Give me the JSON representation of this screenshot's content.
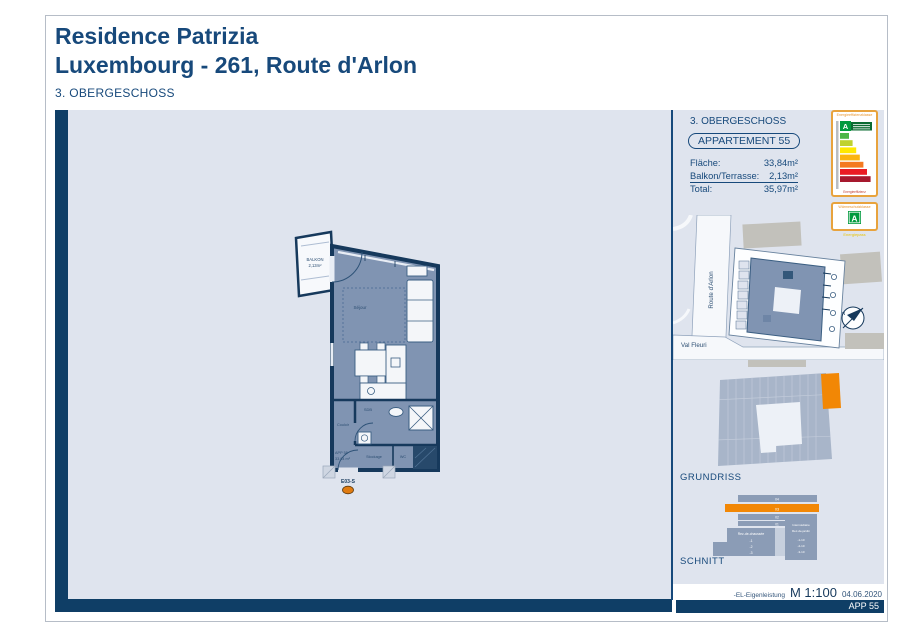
{
  "colors": {
    "navy_text": "#17497B",
    "frame_navy": "#0F3E66",
    "content_lavender": "#DFE4EE",
    "plan_floor": "#8094B2",
    "highlight_orange": "#F28705",
    "map_building_gray": "#C2C1BB",
    "energy_border_orange": "#E8A33D",
    "energy_class_green": "#009A3D",
    "energy_scale_colors": [
      "#4CB648",
      "#BFD22E",
      "#FFE800",
      "#FBB40F",
      "#F47A20",
      "#EA1C24",
      "#A6192E"
    ]
  },
  "header": {
    "title_line1": "Residence Patrizia",
    "title_line2": "Luxembourg - 261, Route d'Arlon",
    "subtitle": "3. OBERGESCHOSS"
  },
  "floorplan": {
    "balkon_line1": "BALKON",
    "balkon_line2": "2,13m²",
    "room_sejour": "Séjour",
    "room_sdb": "SDB",
    "room_couloir": "Couloir",
    "room_stockage": "Stockage",
    "room_wc": "WC",
    "apt_label": "APP 55",
    "apt_area": "33,84 m²",
    "entrance_label": "E03-S"
  },
  "sidebar": {
    "floor_label": "3. OBERGESCHOSS",
    "apartment_badge": "APPARTEMENT 55",
    "area_rows": [
      {
        "label": "Fläche:",
        "value": "33,84m²"
      },
      {
        "label": "Balkon/Terrasse:",
        "value": "2,13m²"
      },
      {
        "label": "Total:",
        "value": "35,97m²"
      }
    ],
    "energy": {
      "box1_header": "Energieeffizienzklasse",
      "class_letter": "A",
      "box1_footer": "Energieeffizienz",
      "box2_header": "Wärmeschutzklasse",
      "class_letter2": "A",
      "doc_label": "Energiepass"
    },
    "map": {
      "street_vertical": "Route d'Arlon",
      "street_bottom": "Val Fleuri",
      "north_letter": "N"
    },
    "grundriss_label": "GRUNDRISS",
    "schnitt_label": "SCHNITT",
    "schnitt": {
      "floors": [
        "04",
        "03",
        "02",
        "01"
      ],
      "left_header": "Rez-de-chaussée",
      "left_rows": [
        "-1",
        "-2",
        "-3"
      ],
      "right_header1": "Intermédiaire",
      "right_header2": "Rez-de-jardin",
      "right_rows": [
        "-1-10",
        "-2-10",
        "-3-10"
      ]
    }
  },
  "footer": {
    "note": "-EL-Eigenleistung",
    "scale": "M 1:100",
    "date": "04.06.2020",
    "bar_label": "APP 55"
  }
}
